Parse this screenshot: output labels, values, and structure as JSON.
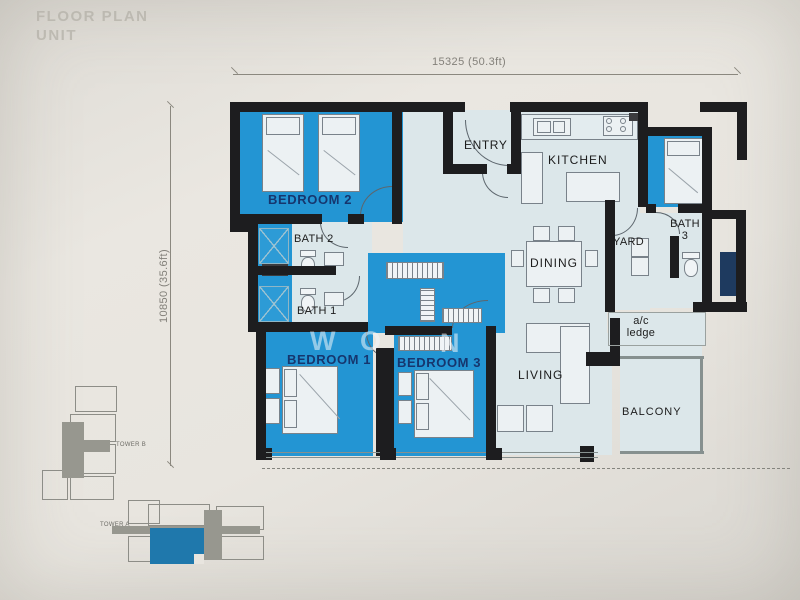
{
  "header": {
    "title_line1": "FLOOR PLAN",
    "title_line2": "UNIT"
  },
  "dimensions": {
    "top": "15325 (50.3ft)",
    "left": "10850 (35.6ft)"
  },
  "rooms": {
    "bedroom2": "BEDROOM 2",
    "bath2": "BATH 2",
    "bath1": "BATH 1",
    "bedroom1": "BEDROOM 1",
    "bedroom3": "BEDROOM 3",
    "entry": "ENTRY",
    "kitchen": "KITCHEN",
    "dining": "DINING",
    "living": "LIVING",
    "yard": "YARD",
    "bath3_line1": "BATH",
    "bath3_line2": "3",
    "ac_line1": "a/c",
    "ac_line2": "ledge",
    "balcony": "BALCONY"
  },
  "watermark": {
    "l1": "W",
    "l2": "O",
    "l3": "N"
  },
  "keyplans": {
    "tower_b": "TOWER B",
    "tower_a": "TOWER A"
  },
  "colors": {
    "highlight": "#2395d3",
    "room_fill": "#dce7ea",
    "wall": "#1d1d1f",
    "paper": "#e8e5df",
    "keyplan_highlight": "#1f78ac"
  }
}
